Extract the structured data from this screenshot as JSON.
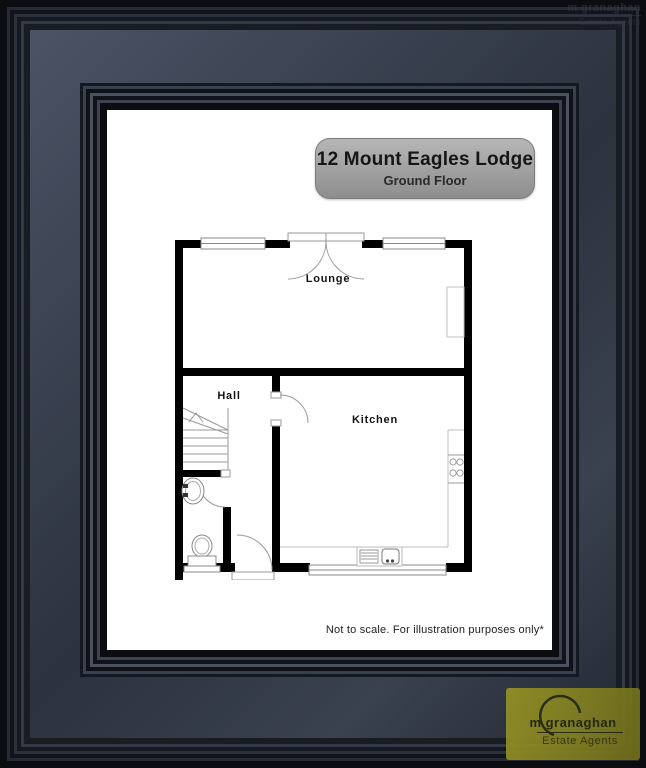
{
  "plaque": {
    "title": "12 Mount Eagles Lodge",
    "subtitle": "Ground Floor"
  },
  "floorplan": {
    "rooms": [
      {
        "name": "Lounge"
      },
      {
        "name": "Hall"
      },
      {
        "name": "Kitchen"
      }
    ],
    "disclaimer": "Not to scale. For illustration purposes only*",
    "features": [
      "stairs",
      "wc-basin",
      "wc-toilet",
      "kitchen-hob",
      "kitchen-sink",
      "french-doors",
      "windows"
    ]
  },
  "branding": {
    "logo_name": "m granaghan",
    "logo_tagline": "Estate Agents",
    "watermark_name": "m granaghan",
    "watermark_tagline": "Estate Agents"
  },
  "colors": {
    "frame_band": "#3a4150",
    "plaque_bg": "#a2a2a2",
    "logo_bg": "#8a8724",
    "wall": "#000000"
  }
}
